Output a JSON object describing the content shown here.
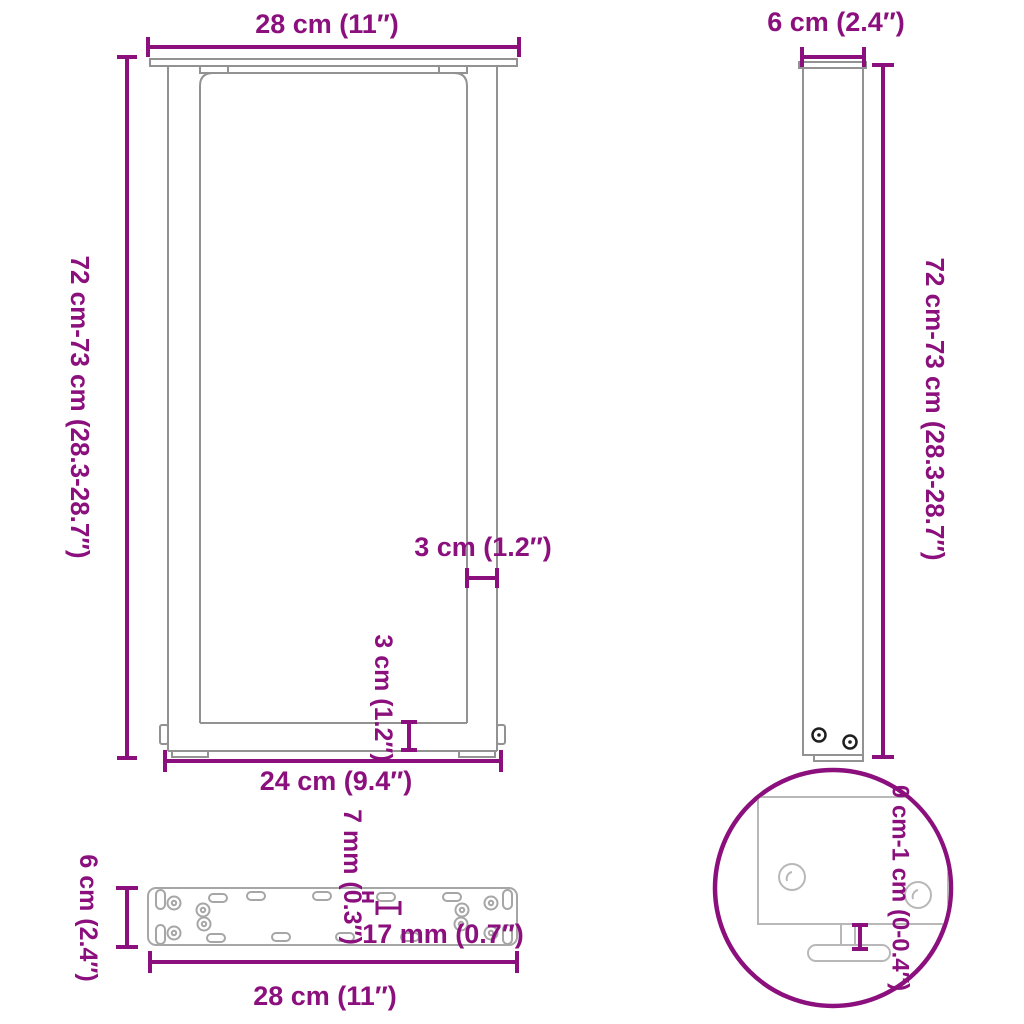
{
  "title": "Table legs U-shaped dimension diagram",
  "colors": {
    "dimension_accent": "#8b0f7d",
    "drawing_gray": "#929292",
    "plate_gray": "#a6a6a6",
    "detail_gray": "#b8b8b8",
    "screw_dark": "#1f1f1f",
    "background": "#ffffff"
  },
  "front_view": {
    "width_label": "28 cm (11″)",
    "height_label": "72 cm-73 cm (28.3-28.7″)",
    "leg_thickness_label": "3 cm (1.2″)",
    "crossbar_height_label": "3 cm (1.2″)",
    "base_width_label": "24 cm (9.4″)"
  },
  "side_view": {
    "depth_label": "6 cm (2.4″)",
    "height_label": "72 cm-73 cm (28.3-28.7″)"
  },
  "plate_view": {
    "depth_label": "6 cm (2.4″)",
    "slot_width_label": "7 mm (0.3″)",
    "slot_length_label": "17 mm (0.7″)",
    "width_label": "28 cm (11″)"
  },
  "detail_view": {
    "foot_adjustment_label": "0 cm-1 cm (0-0.4″)"
  }
}
